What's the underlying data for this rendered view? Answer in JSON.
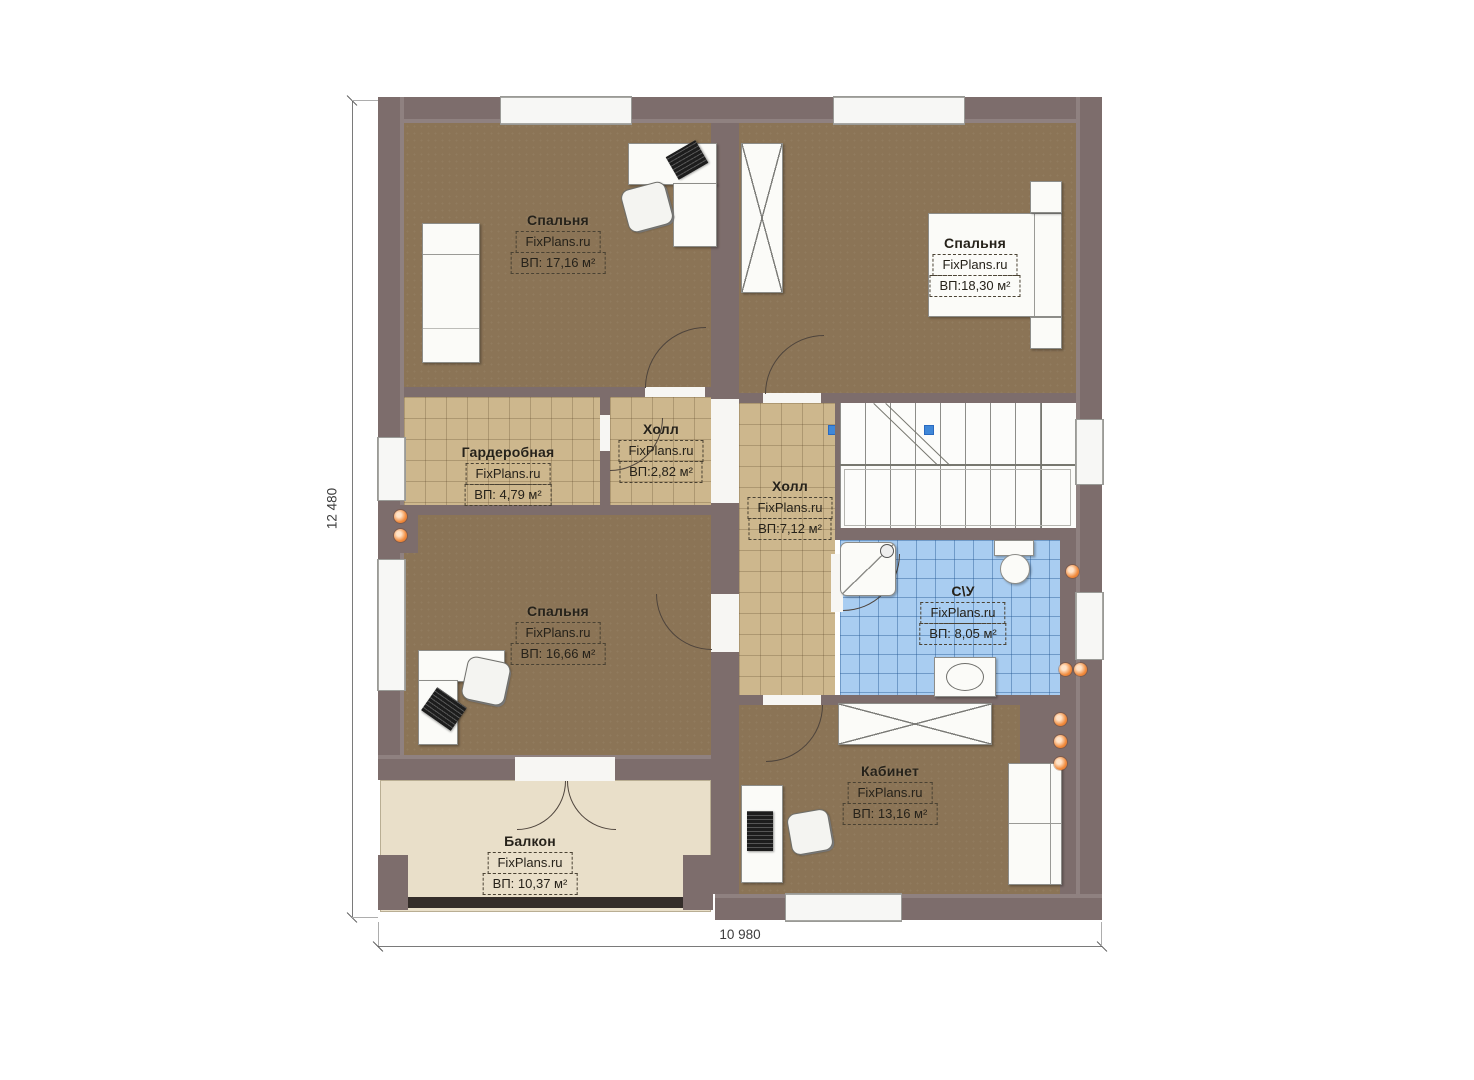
{
  "rooms": [
    {
      "key": "bedroom-top-left",
      "name": "Спальня",
      "site": "FixPlans.ru",
      "area": "ВП: 17,16 м²"
    },
    {
      "key": "bedroom-top-right",
      "name": "Спальня",
      "site": "FixPlans.ru",
      "area": "ВП:18,30 м²"
    },
    {
      "key": "wardrobe-room",
      "name": "Гардеробная",
      "site": "FixPlans.ru",
      "area": "ВП: 4,79 м²"
    },
    {
      "key": "hall-small",
      "name": "Холл",
      "site": "FixPlans.ru",
      "area": "ВП:2,82 м²"
    },
    {
      "key": "hall-center",
      "name": "Холл",
      "site": "FixPlans.ru",
      "area": "ВП:7,12 м²"
    },
    {
      "key": "bathroom",
      "name": "С\\У",
      "site": "FixPlans.ru",
      "area": "ВП: 8,05 м²"
    },
    {
      "key": "bedroom-bottom-left",
      "name": "Спальня",
      "site": "FixPlans.ru",
      "area": "ВП: 16,66 м²"
    },
    {
      "key": "office",
      "name": "Кабинет",
      "site": "FixPlans.ru",
      "area": "ВП: 13,16 м²"
    },
    {
      "key": "balcony",
      "name": "Балкон",
      "site": "FixPlans.ru",
      "area": "ВП: 10,37 м²"
    }
  ],
  "dimensions": {
    "total_width": "10 980",
    "total_height": "12 480"
  },
  "colors": {
    "wall": "#7d6d6c",
    "floor_wood": "#8b7456",
    "floor_tile": "#cdb78d",
    "floor_bath": "#a9cdf1",
    "floor_balcony": "#e9dfc9",
    "radiator_dot": "#e8772e",
    "stair_marker": "#3f87d8"
  }
}
